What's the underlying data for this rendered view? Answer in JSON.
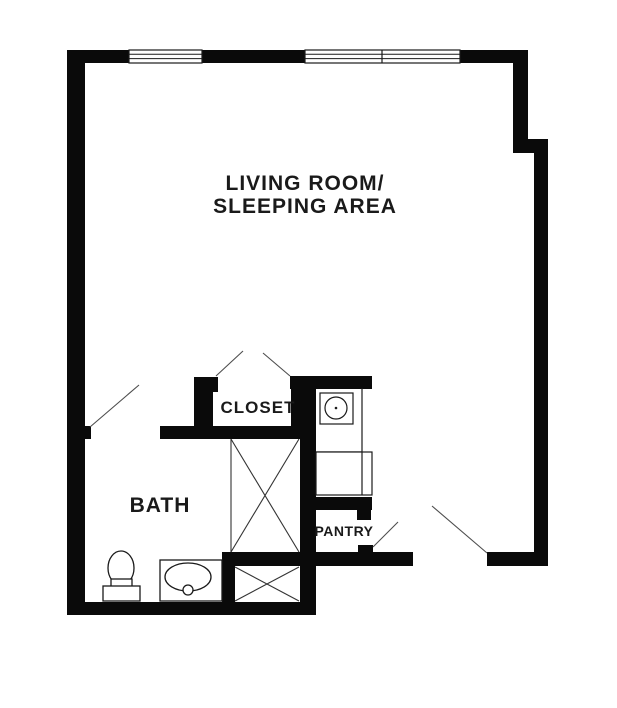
{
  "diagram": {
    "type": "floor-plan",
    "labels": {
      "living_room_line1": "LIVING ROOM/",
      "living_room_line2": "SLEEPING AREA",
      "bath": "BATH",
      "closet": "CLOSET",
      "pantry": "PANTRY"
    },
    "fixtures": [
      {
        "name": "toilet",
        "room": "bath"
      },
      {
        "name": "vanity-sink",
        "room": "bath"
      },
      {
        "name": "utility-x-box-large",
        "room": "bath"
      },
      {
        "name": "utility-x-box-small",
        "room": "bath"
      },
      {
        "name": "washer-dryer-unit",
        "room": "pantry"
      },
      {
        "name": "counter-appliance",
        "room": "pantry"
      }
    ],
    "features": [
      "window-single-top-left",
      "window-double-top-right",
      "bath-door-swing",
      "closet-double-door-swing",
      "pantry-door-swing",
      "entry-door-swing"
    ],
    "colors": {
      "wall": "#0a0a0a",
      "background": "#ffffff",
      "door_line": "#4d4d4d",
      "fixture_stroke": "#1a1a1a",
      "text": "#1a1a1a"
    }
  }
}
